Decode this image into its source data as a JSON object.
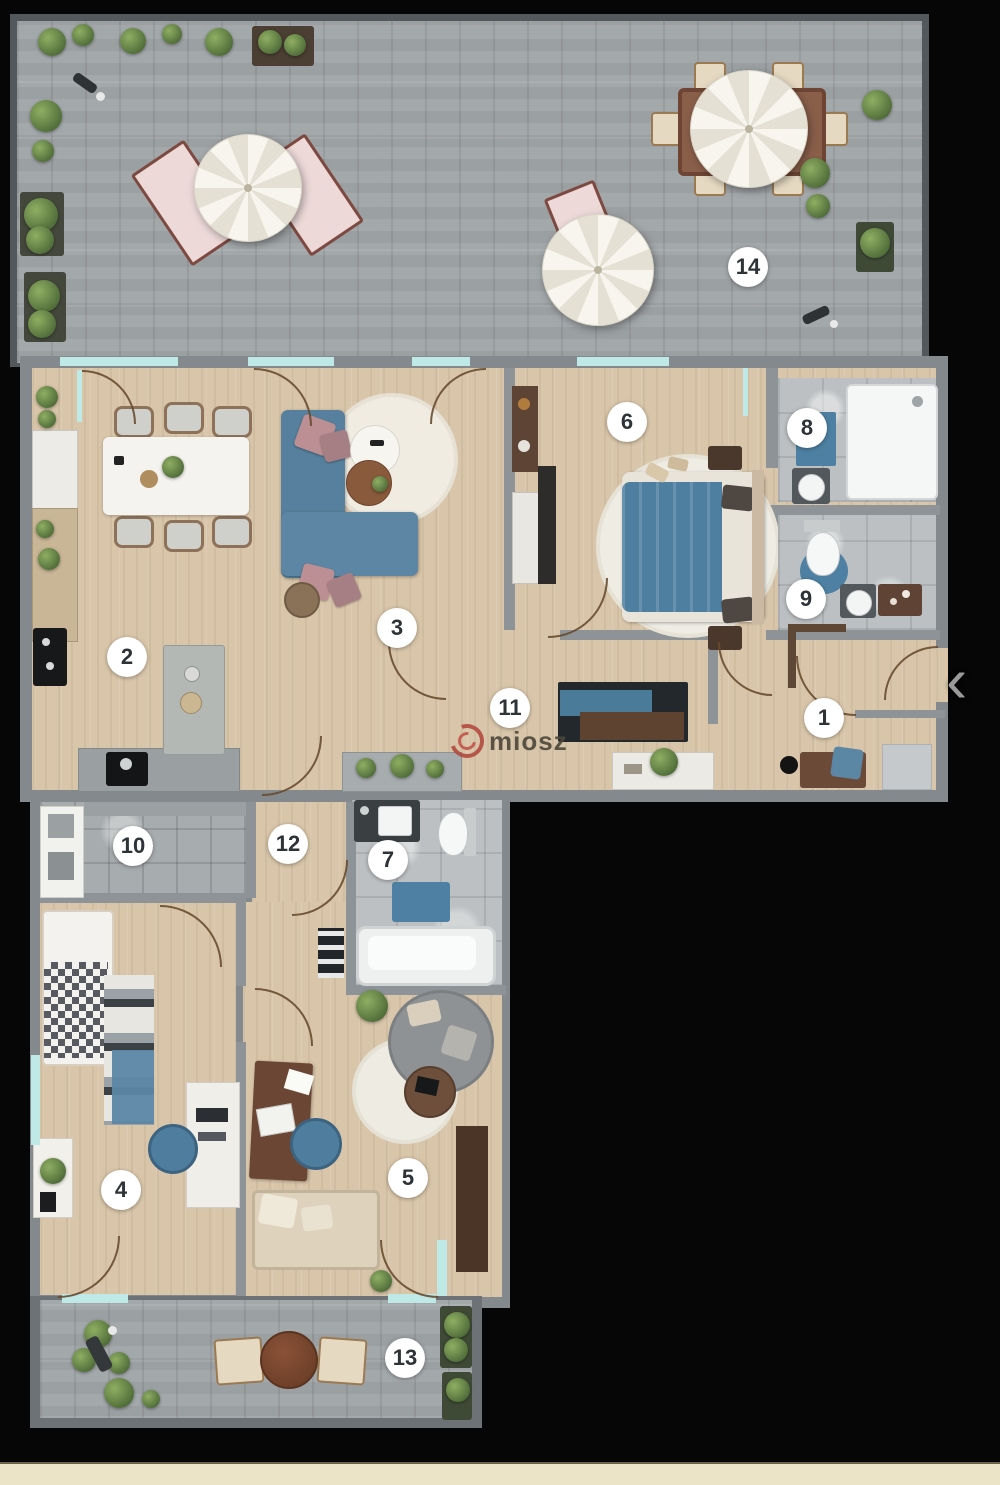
{
  "view": {
    "background_color": "#060606",
    "bottom_band_color": "#ece4c6",
    "nav": {
      "prev_chevron": "‹"
    }
  },
  "watermark": {
    "brand": "miosz",
    "logo_color": "#b34a3f",
    "text_color": "#4c473b"
  },
  "rooms": [
    {
      "label": "1",
      "name": "entrance-hall"
    },
    {
      "label": "2",
      "name": "kitchen"
    },
    {
      "label": "3",
      "name": "living-room"
    },
    {
      "label": "4",
      "name": "bedroom-2"
    },
    {
      "label": "5",
      "name": "study-room"
    },
    {
      "label": "6",
      "name": "master-bedroom"
    },
    {
      "label": "7",
      "name": "bathroom"
    },
    {
      "label": "8",
      "name": "shower-room"
    },
    {
      "label": "9",
      "name": "wc"
    },
    {
      "label": "10",
      "name": "utility-room"
    },
    {
      "label": "11",
      "name": "corridor"
    },
    {
      "label": "12",
      "name": "hallway"
    },
    {
      "label": "13",
      "name": "balcony"
    },
    {
      "label": "14",
      "name": "roof-terrace"
    }
  ],
  "colors": {
    "wall": "#84898d",
    "wood_floor": "#d9c6aa",
    "paving": "#a3a8ab",
    "bath_tile": "#bcc0c2",
    "window_glass": "#bfe9e6",
    "sofa_blue": "#4f7ea0",
    "accent_pink": "#bb8f93"
  }
}
